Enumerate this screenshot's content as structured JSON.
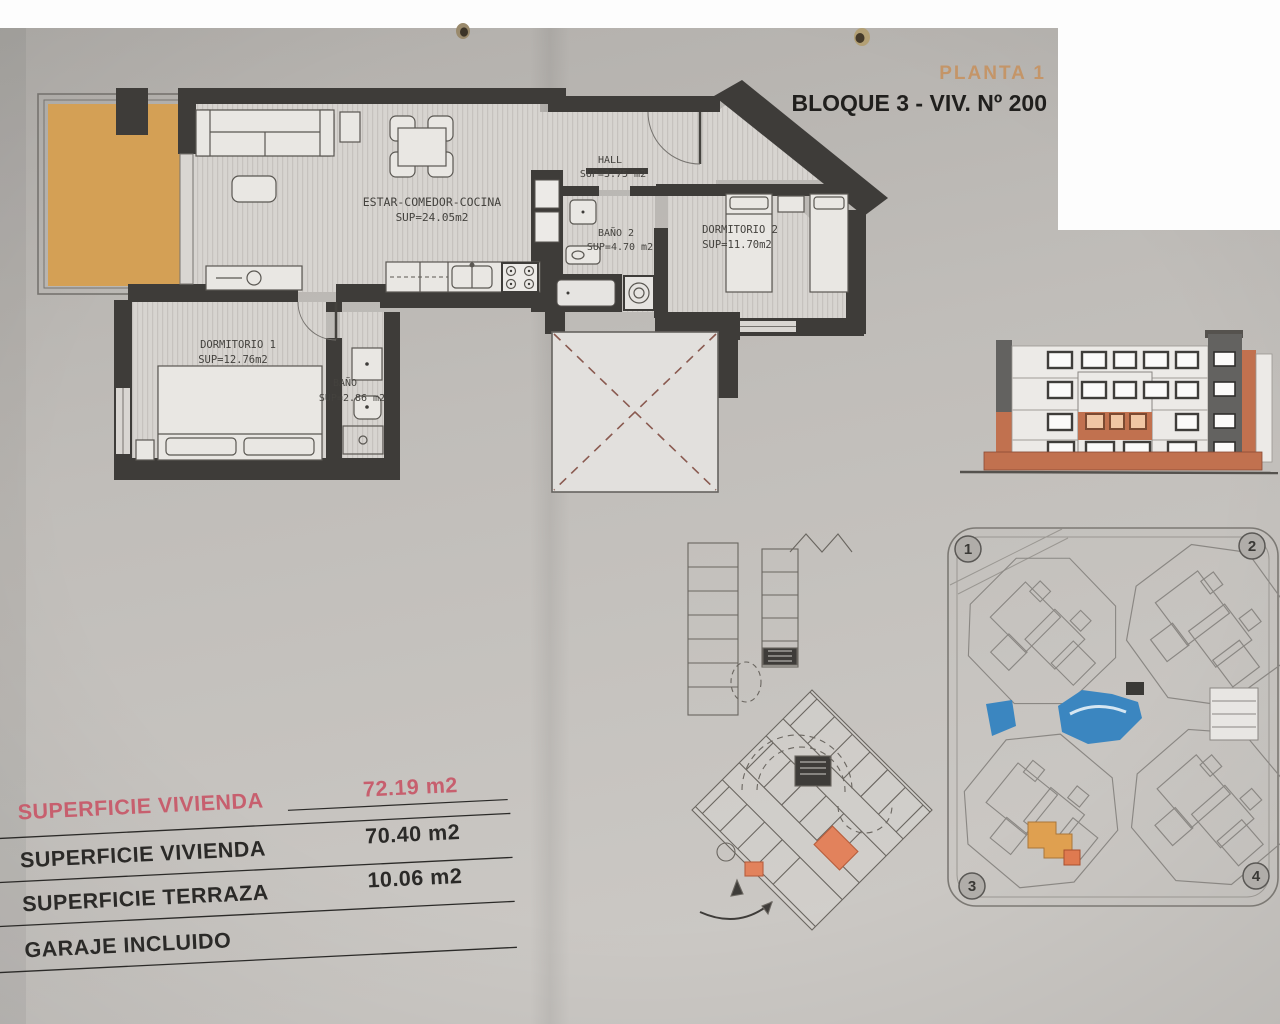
{
  "header": {
    "floor_label": "PLANTA 1",
    "unit_label": "BLOQUE 3 - VIV. Nº 200"
  },
  "floor_plan": {
    "living": {
      "name": "ESTAR-COMEDOR-COCINA",
      "area": "SUP=24.05m2"
    },
    "hall": {
      "name": "HALL",
      "area": "SUP=3.75 m2"
    },
    "bath2": {
      "name": "BAÑO 2",
      "area": "SUP=4.70 m2"
    },
    "bedroom2": {
      "name": "DORMITORIO 2",
      "area": "SUP=11.70m2"
    },
    "bedroom1": {
      "name": "DORMITORIO 1",
      "area": "SUP=12.76m2"
    },
    "bath1": {
      "name": "BAÑO",
      "area": "SUP=2.86 m2"
    }
  },
  "site_plan": {
    "markers": [
      "1",
      "2",
      "3",
      "4"
    ]
  },
  "summary": {
    "rows": [
      {
        "label": "SUPERFICIE VIVIENDA",
        "value": "72.19 m2"
      },
      {
        "label": "SUPERFICIE VIVIENDA",
        "value": "70.40 m2"
      },
      {
        "label": "SUPERFICIE TERRAZA",
        "value": "10.06 m2"
      },
      {
        "label": "GARAJE INCLUIDO",
        "value": ""
      }
    ]
  },
  "colors": {
    "terrace_orange": "#d4a055",
    "terracotta": "#c1714f",
    "garage_highlight": "#e2825c",
    "pool_blue": "#3b86c0",
    "highlight_pink": "#c75f6e",
    "title_tan": "#c49568"
  }
}
